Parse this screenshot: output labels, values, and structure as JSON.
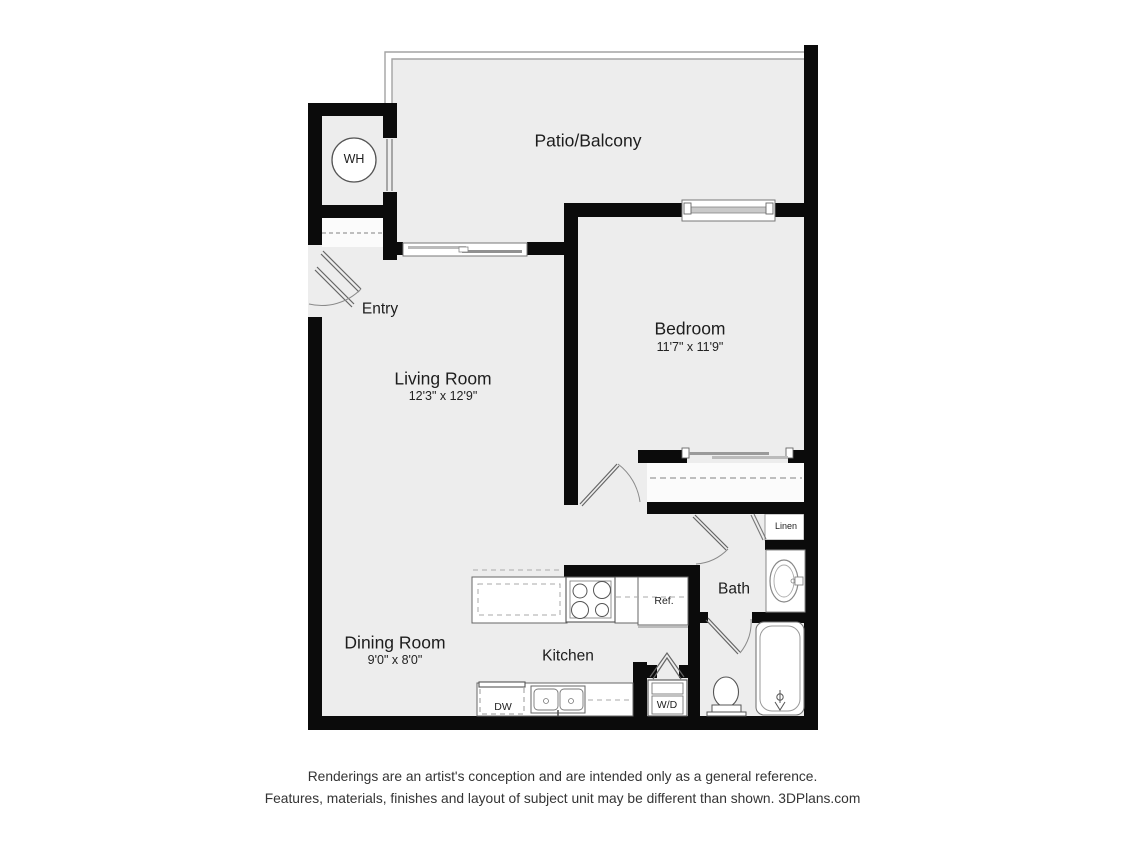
{
  "floorplan": {
    "rooms": {
      "patio": {
        "label": "Patio/Balcony"
      },
      "entry": {
        "label": "Entry"
      },
      "living": {
        "label": "Living Room",
        "dims": "12'3\" x 12'9\""
      },
      "bedroom": {
        "label": "Bedroom",
        "dims": "11'7\" x 11'9\""
      },
      "dining": {
        "label": "Dining Room",
        "dims": "9'0\" x 8'0\""
      },
      "kitchen": {
        "label": "Kitchen"
      },
      "bath": {
        "label": "Bath"
      }
    },
    "fixtures": {
      "water_heater": "WH",
      "linen": "Linen",
      "refrigerator": "Ref.",
      "dishwasher": "DW",
      "washer_dryer": "W/D"
    },
    "colors": {
      "wall": "#0b0b0b",
      "floor": "#ededed",
      "fixture_line": "#666666"
    }
  },
  "disclaimer": {
    "line1": "Renderings are an artist's conception and are intended only as a general reference.",
    "line2": "Features, materials, finishes and layout of subject unit may be different than shown. 3DPlans.com"
  }
}
